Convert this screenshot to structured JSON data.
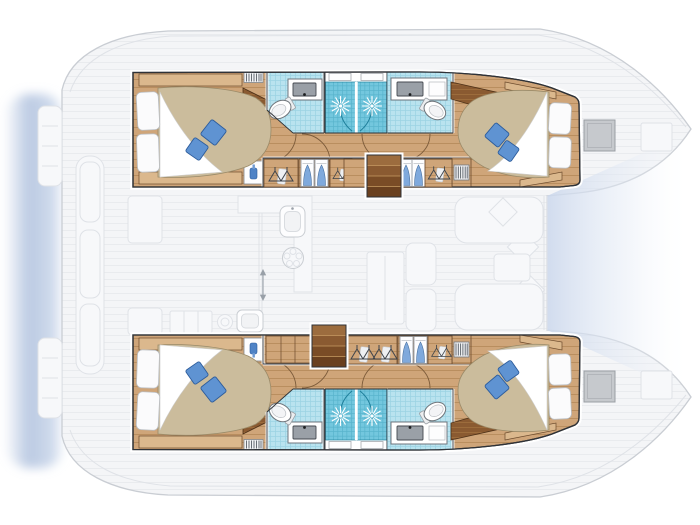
{
  "meta": {
    "title": "Catamaran 4-cabin interior layout plan (top-down deck plan, bow to the right)",
    "image_type": "yacht floor plan illustration",
    "visible_text": "none"
  },
  "palette": {
    "deck": "#f4f5f7",
    "deckLine": "#e9ebee",
    "hullStroke": "#c9cdd3",
    "shadow": "#b7c7e1",
    "bowGap": "#ccd8ec",
    "wood": "#cfa579",
    "woodLine": "#b78c5c",
    "woodDark": "#8a5a31",
    "woodDarkLine": "#a1703f",
    "woodLight": "#dbb88d",
    "woodEdge": "#6b4a2c",
    "tile": "#b9e3ef",
    "tileLine": "#9ad2e3",
    "shower": "#73c7de",
    "showerLine": "#57b3cc",
    "showerGlass": "#1f7f9b",
    "duvet": "#cbbc9c",
    "duvetEdge": "#a2916d",
    "pillow": "#fbfbfc",
    "pillowStroke": "#b9bdc2",
    "bluePillow": "#5f93d2",
    "bluePillowDark": "#2d5c9b",
    "blueDrape": "#7fa9dc",
    "basin": "#9aa0a7",
    "basinDark": "#454a50",
    "fixture": "#70767c",
    "ink": "#2f3237",
    "faintFill": "#f7f8fa",
    "faintLine": "#dfe2e7"
  },
  "vessel": {
    "type": "catamaran",
    "orientation": "bow right, stern left",
    "hulls": [
      {
        "id": "top-hull",
        "rooms": [
          {
            "name": "aft cabin",
            "features": [
              "double bed",
              "2 white pillows",
              "2 blue throw pillows",
              "white sheet fold",
              "shelf strips",
              "louver vent",
              "bottle cabinet"
            ]
          },
          {
            "name": "aft head",
            "fixtures": [
              "toilet",
              "sink with counter",
              "tiled floor"
            ]
          },
          {
            "name": "shower stalls",
            "count": 2,
            "fixtures": [
              "shower rose starburst",
              "curved glass door",
              "window above"
            ]
          },
          {
            "name": "forward head",
            "fixtures": [
              "toilet",
              "sink with counter",
              "tiled floor"
            ]
          },
          {
            "name": "forward cabin",
            "features": [
              "double bed",
              "2 white pillows",
              "2 blue throw pillows",
              "angled cabinet"
            ]
          }
        ],
        "corridor": [
          "wardrobe with hangers",
          "wardrobe with blue drape panels",
          "companionway stairs",
          "louvered locker"
        ]
      },
      {
        "id": "bottom-hull",
        "mirror_of": "top-hull",
        "corridor": [
          "plain cabinets",
          "companionway stairs",
          "wardrobe with hangers",
          "wardrobe with blue drape panels",
          "louvered locker"
        ]
      }
    ],
    "saloon": {
      "features": [
        "galley counter",
        "galley sink",
        "stove",
        "aft cabinets",
        "round vent",
        "second sink",
        "dining table",
        "sofa bench",
        "diamond cushions",
        "forward lounge",
        "coffee table",
        "sliding door arrow"
      ]
    },
    "cockpit": {
      "features": [
        "aft bench",
        "two tables",
        "transom steps port",
        "transom steps starboard"
      ]
    },
    "deck": {
      "features": [
        "bow hatch top",
        "anchor locker top",
        "bow hatch bottom",
        "anchor locker bottom",
        "between-bows gradient area",
        "stern water shadow"
      ]
    },
    "counts": {
      "cabins": 4,
      "heads": 2,
      "shower_stalls": 4,
      "toilets": 4,
      "beds": 4,
      "stairs": 2
    }
  }
}
